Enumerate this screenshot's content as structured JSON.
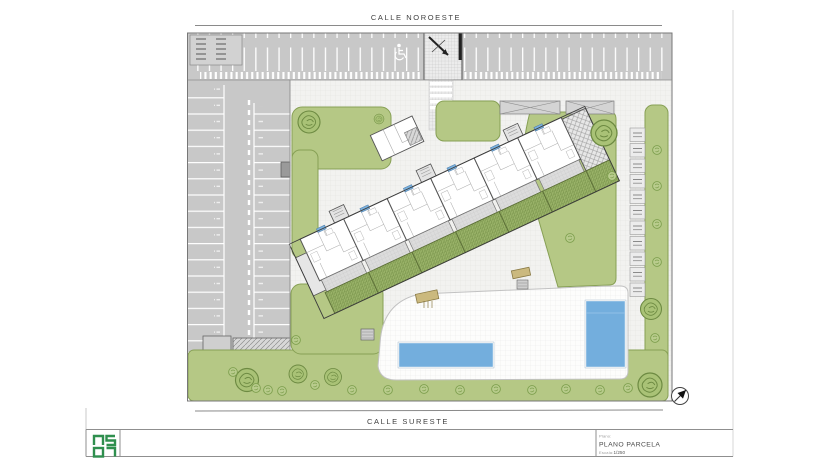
{
  "streets": {
    "top_label": "CALLE NOROESTE",
    "bottom_label": "CALLE SURESTE"
  },
  "title_block": {
    "plano_label": "Plano:",
    "plano_value": "PLANO PARCELA",
    "escala_label": "Escala:",
    "escala_value": "1/250",
    "logo_mark": "0507"
  },
  "drawing": {
    "type": "architectural-site-plan",
    "features": [
      "top-parking-row",
      "side-parking-rows",
      "accessible-parking-stall",
      "vehicle-ramp-entrance",
      "pedestrian-crossing",
      "angled-apartment-block",
      "private-hatched-gardens",
      "lawn-areas",
      "trees",
      "bushes",
      "long-swimming-pool",
      "small-swimming-pool",
      "white-pool-deck",
      "bike-stall-column",
      "pergola-carports",
      "north-compass"
    ],
    "colors": {
      "lawn_green": "#b5c885",
      "garden_green": "#9bb46a",
      "asphalt_gray": "#c8c8c8",
      "paving_light": "#f2f2f0",
      "pool_blue": "#73aedd",
      "logo_green": "#2f8f4e",
      "wall_dark": "#444444"
    }
  }
}
